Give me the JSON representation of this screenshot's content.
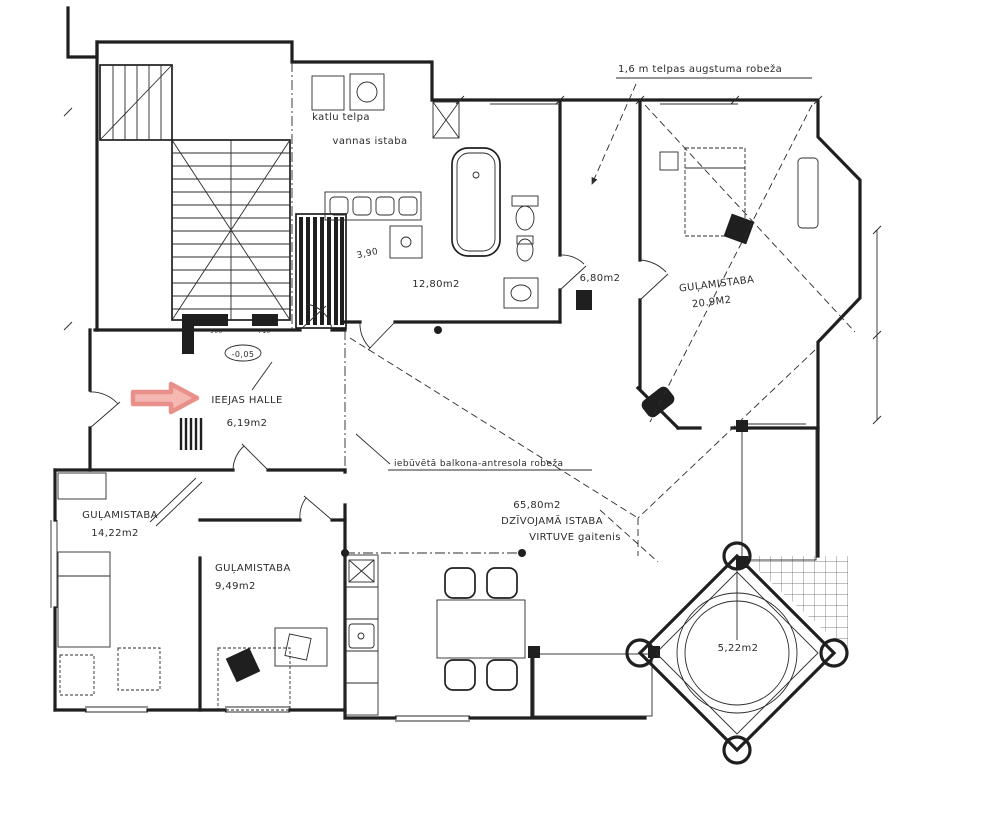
{
  "annotations": {
    "height_limit_note": "1,6 m telpas augstuma robeža",
    "mezzanine_note": "iebūvētā balkona-antresola robeža",
    "level_mark": "-0,05",
    "dim_sauna": "3,90",
    "dim_900": "900",
    "dim_710": "710"
  },
  "rooms": {
    "boiler_room": {
      "name": "katlu telpa"
    },
    "bathroom_label": {
      "name": "vannas istaba"
    },
    "bathroom": {
      "area": "12,80m2"
    },
    "small_hall": {
      "area": "6,80m2"
    },
    "bedroom_right": {
      "name": "GUĻAMISTABA",
      "area": "20.9M2"
    },
    "entry_hall": {
      "name": "IEEJAS HALLE",
      "area": "6,19m2"
    },
    "living_room": {
      "area": "65,80m2",
      "name": "DZĪVOJAMĀ ISTABA",
      "subtitle": "VIRTUVE gaitenis"
    },
    "bedroom_left": {
      "name": "GUĻAMISTABA",
      "area": "14,22m2"
    },
    "bedroom_middle": {
      "name": "GUĻAMISTABA",
      "area": "9,49m2"
    },
    "tower_balcony": {
      "area": "5,22m2"
    }
  },
  "colors": {
    "ink": "#1f1f1f",
    "paper": "#ffffff",
    "arrow_stroke": "#e9908b",
    "arrow_fill": "#f5b7b2"
  }
}
